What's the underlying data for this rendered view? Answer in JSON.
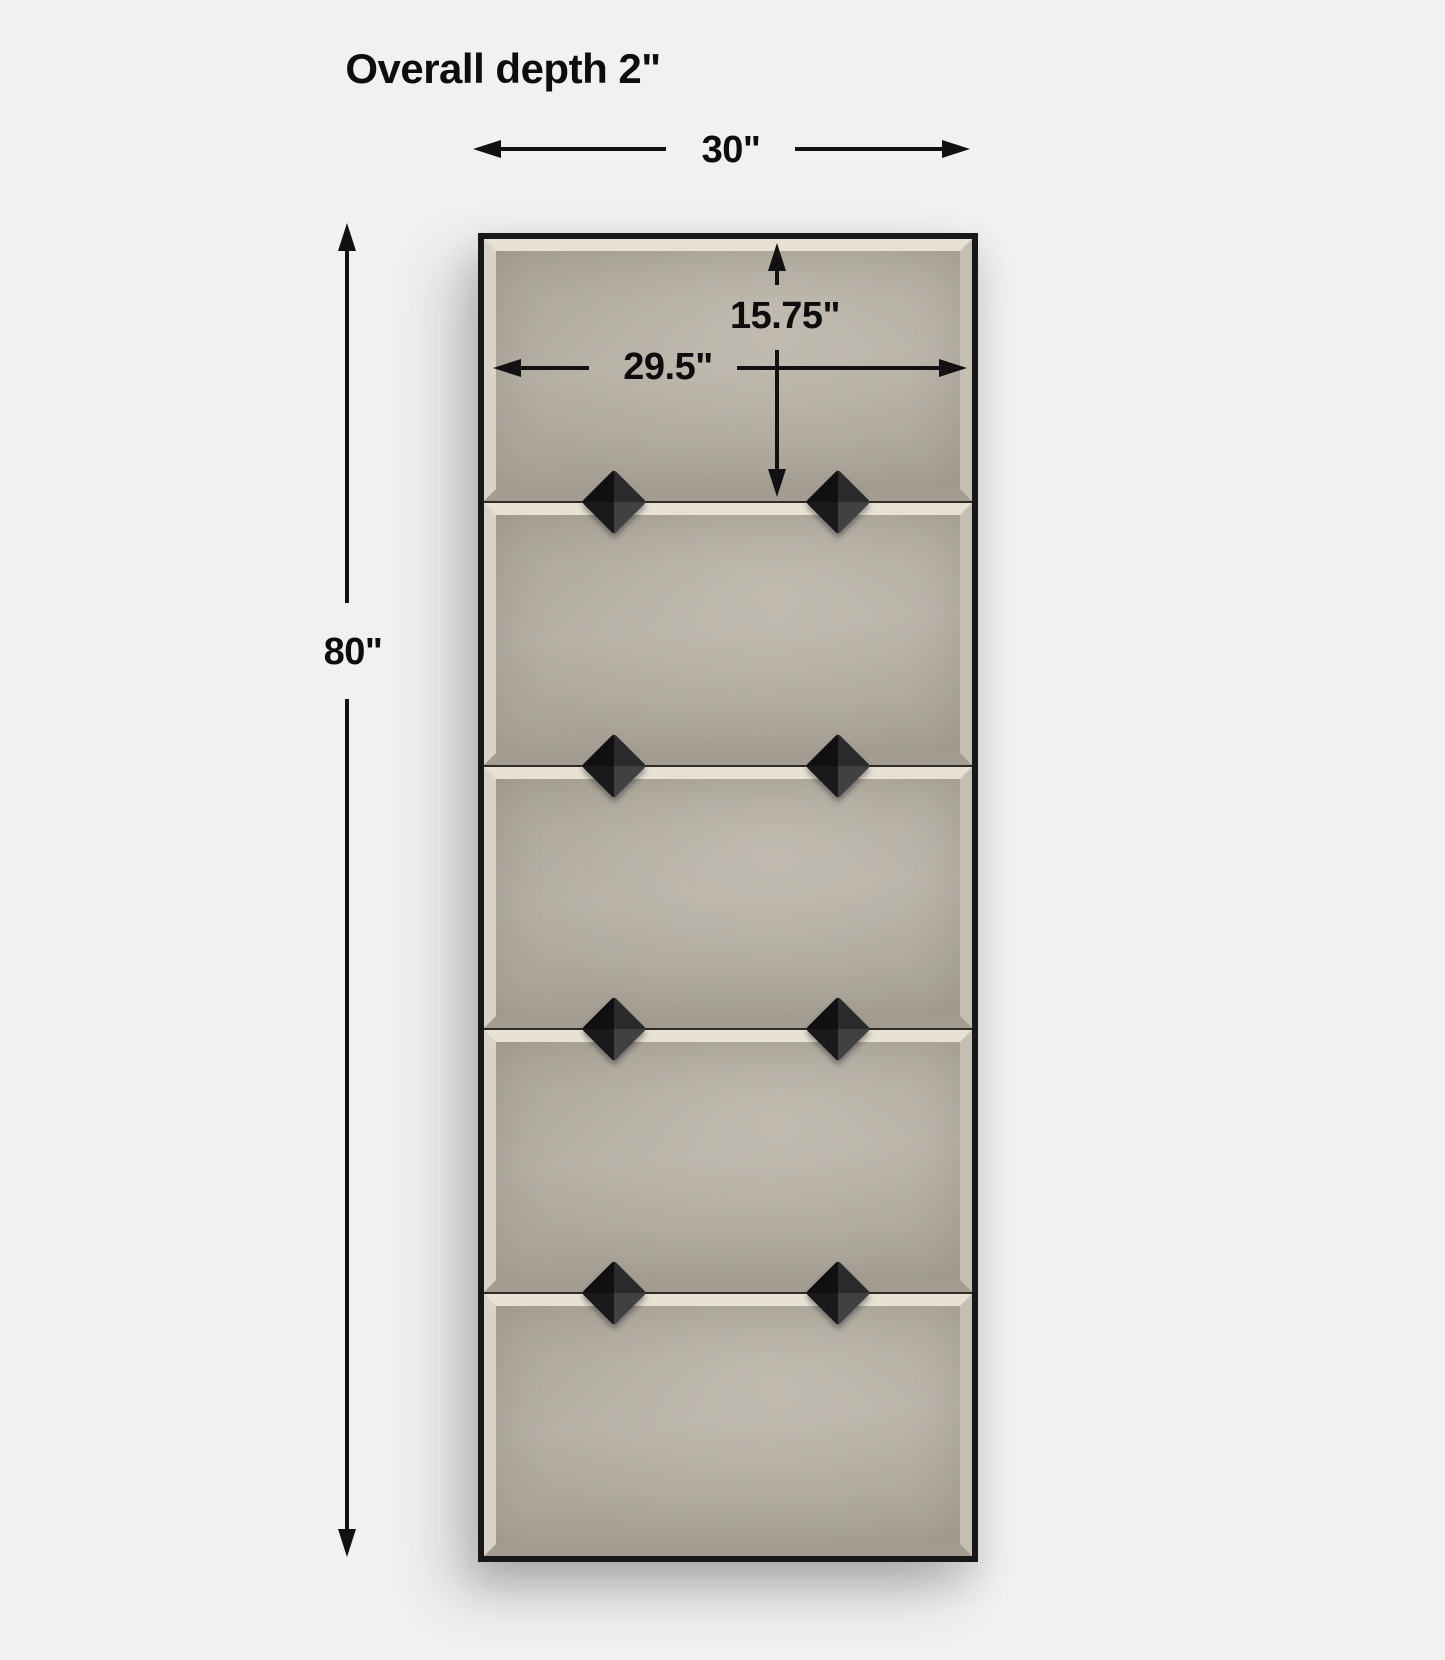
{
  "title": "Overall depth 2\"",
  "diagram": {
    "object": "five-panel beveled wall mirror with thin black frame and pyramid studs",
    "panel_count": 5,
    "stud_rows": 4,
    "studs_per_row": 2,
    "dimensions": {
      "overall_depth": "2\"",
      "overall_width": "30\"",
      "overall_height": "80\"",
      "glass_width": "29.5\"",
      "panel_height": "15.75\""
    },
    "colors": {
      "background": "#f1f1ef",
      "annotation_ink": "#111111",
      "frame": "#181818",
      "glass": "#b5afa3",
      "bevel_highlight": "#e7e2d3",
      "stud": "#1a1a1c"
    }
  }
}
